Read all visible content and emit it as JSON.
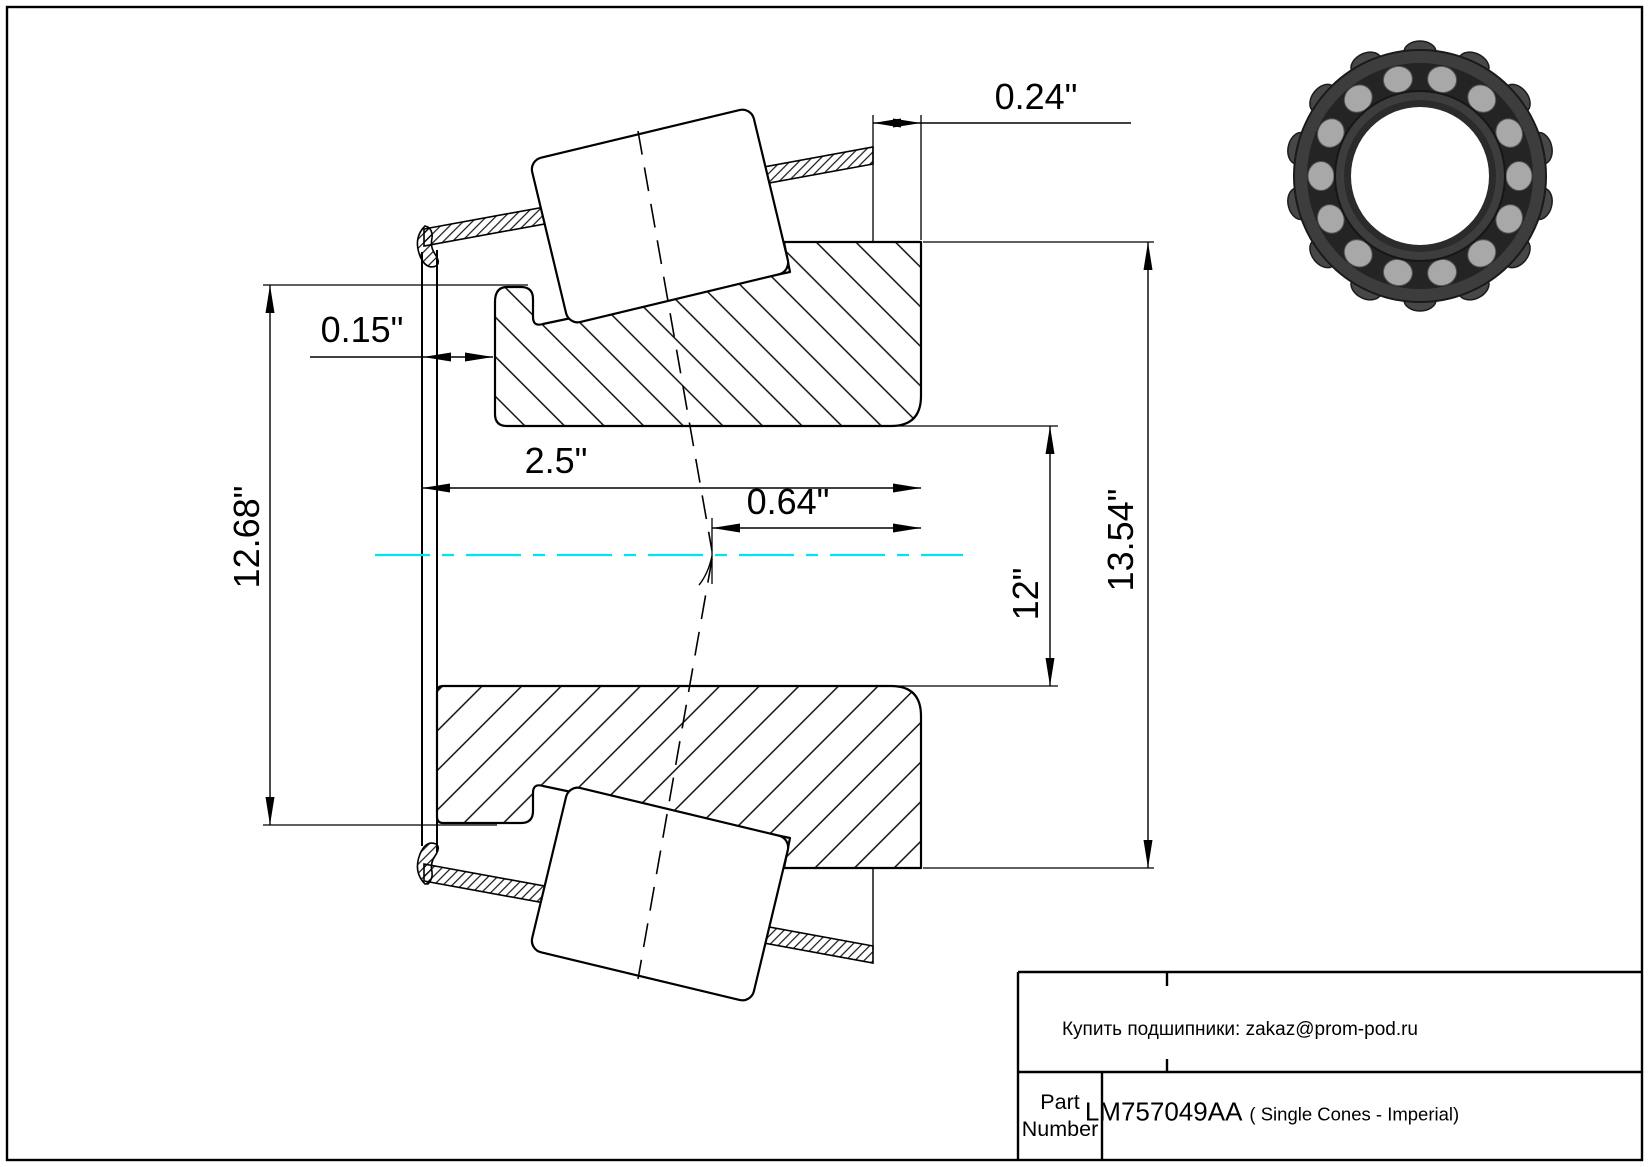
{
  "drawing_title": "Tapered roller bearing single cone cross-section",
  "dims": {
    "cage_back_offset": "0.24\"",
    "front_offset": "0.15\"",
    "cone_width": "2.5\"",
    "effective_center": "0.64\"",
    "bore_diameter": "12\"",
    "front_rib_diameter": "12.68\"",
    "back_rib_diameter": "13.54\""
  },
  "title_block": {
    "contact_line": "Купить подшипники: zakaz@prom-pod.ru",
    "part_label": "Part Number",
    "part_number": "LM757049AA",
    "part_suffix": "( Single Cones - Imperial)"
  },
  "colors": {
    "centerline": "#00E4F2",
    "line": "#000000",
    "background": "#FFFFFF",
    "bearing_dark": "#3D3D3D",
    "bearing_roller": "#A8A8A8"
  }
}
